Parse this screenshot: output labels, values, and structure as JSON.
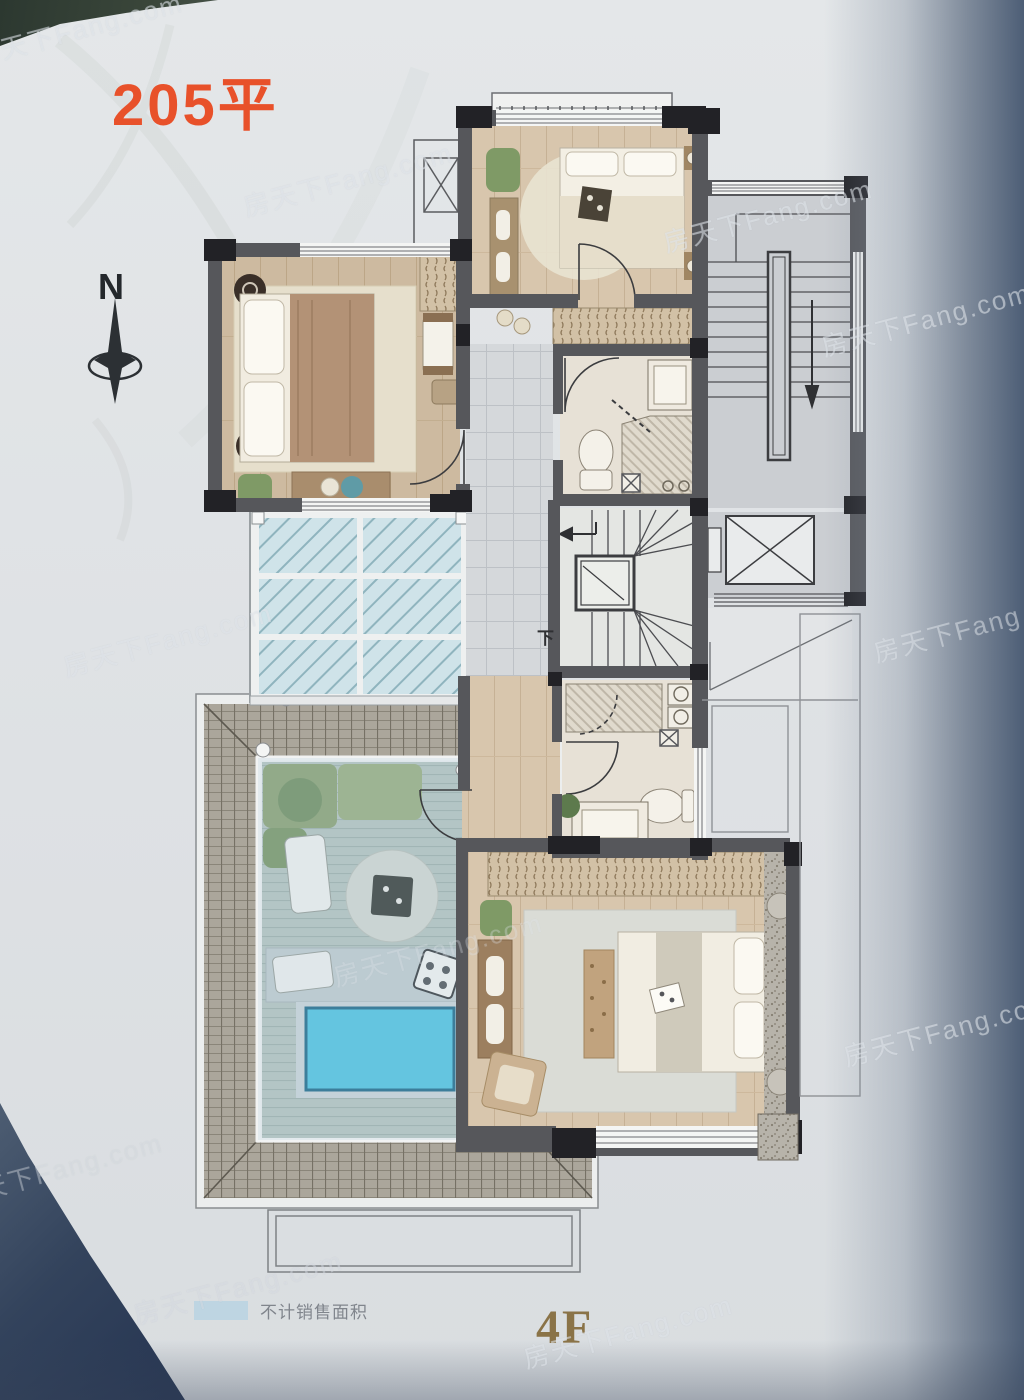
{
  "meta": {
    "description": "Photographed real-estate floor plan page, 4th floor of a 205 sqm duplex unit"
  },
  "labels": {
    "area": "205平",
    "floor": "4F",
    "compass_north": "N",
    "stairs_down": "下"
  },
  "legend": {
    "items": [
      {
        "swatch_color": "#b9d3e2",
        "label": "不计销售面积"
      }
    ]
  },
  "watermark": {
    "text": "房天下Fang.com"
  },
  "colors": {
    "area_label": "#e8512a",
    "floor_label": "#8a7347",
    "page_bg": "#dfe2e5",
    "wall": "#56575b",
    "pier": "#222226",
    "pool_water": "#57c6e2",
    "glass_skylight": "#cfe3e9",
    "deck_wood": "#b7c6c1",
    "roof_tile": "#aba69b",
    "bedroom_wood": "#d8c6ad",
    "tile_floor": "#d5d8db",
    "corner_shadow": "#33435c"
  }
}
